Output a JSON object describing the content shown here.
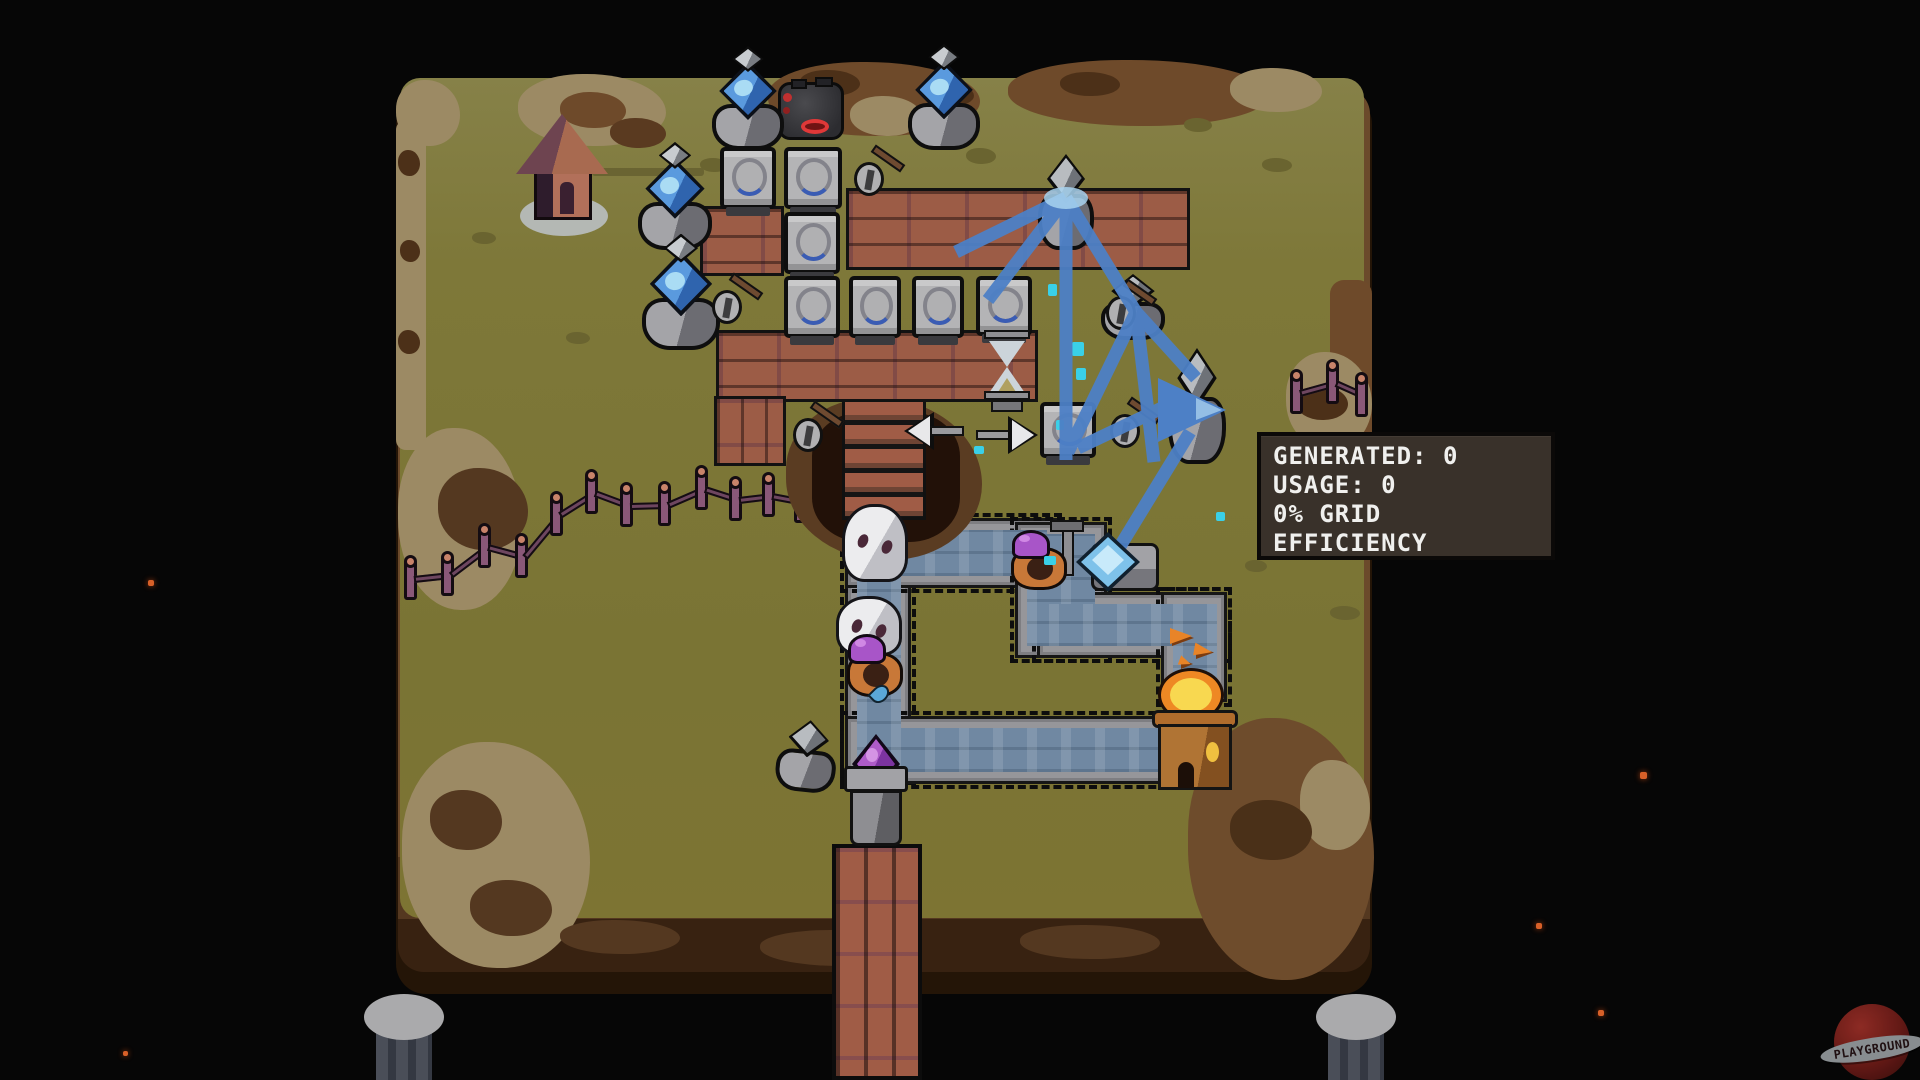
{
  "hud": {
    "power_tooltip": {
      "lines": [
        "GENERATED: 0",
        "USAGE: 0",
        "0% GRID",
        "EFFICIENCY"
      ],
      "generated_value": 0,
      "usage_value": 0,
      "grid_efficiency_percent": 0
    }
  },
  "branding": {
    "logo_text": "PLAYGROUND"
  },
  "colors": {
    "background": "#060606",
    "grass": "#7e7839",
    "dirt": "#6b4a2b",
    "tan_dirt": "#9c8a64",
    "beam_blue": "#4d80c6",
    "cobble_path": "#7088a2",
    "crystal_blue": "#4a8cd8",
    "crystal_purple": "#9948b8",
    "flame_orange": "#ee8824",
    "imp_hood_purple": "#a855c8",
    "ghost_white": "#ececee",
    "tooltip_bg": "#39312a",
    "tooltip_text": "#f0f0ee",
    "ember_orange": "#d86028"
  },
  "entities": {
    "crystal_tower": {
      "icon": "blue-crystal-on-stone",
      "count": 4
    },
    "power_pylon": {
      "icon": "gray-diamond-stone",
      "count": 5
    },
    "generator_machine": {
      "icon": "gray-box-dial",
      "count": 8
    },
    "red_forge": {
      "icon": "dark-machine-red-glow",
      "count": 1
    },
    "hourglass": {
      "icon": "hourglass",
      "count": 1
    },
    "ghost": {
      "icon": "white-ghost",
      "count": 2
    },
    "imp_worker": {
      "icon": "purple-hood-imp",
      "count": 2
    },
    "brazier_tower": {
      "icon": "flame-tower",
      "count": 1
    },
    "gate_crystal": {
      "icon": "purple-crystal-pedestal",
      "count": 1
    },
    "shovel": {
      "icon": "shovel-in-ground",
      "count": 5
    },
    "direction_arrows": {
      "icons": [
        "arrow-left",
        "arrow-right"
      ]
    },
    "watch_house": {
      "icon": "small-house",
      "count": 1
    },
    "support_pillar": {
      "icon": "stone-pillar",
      "count": 2
    }
  }
}
